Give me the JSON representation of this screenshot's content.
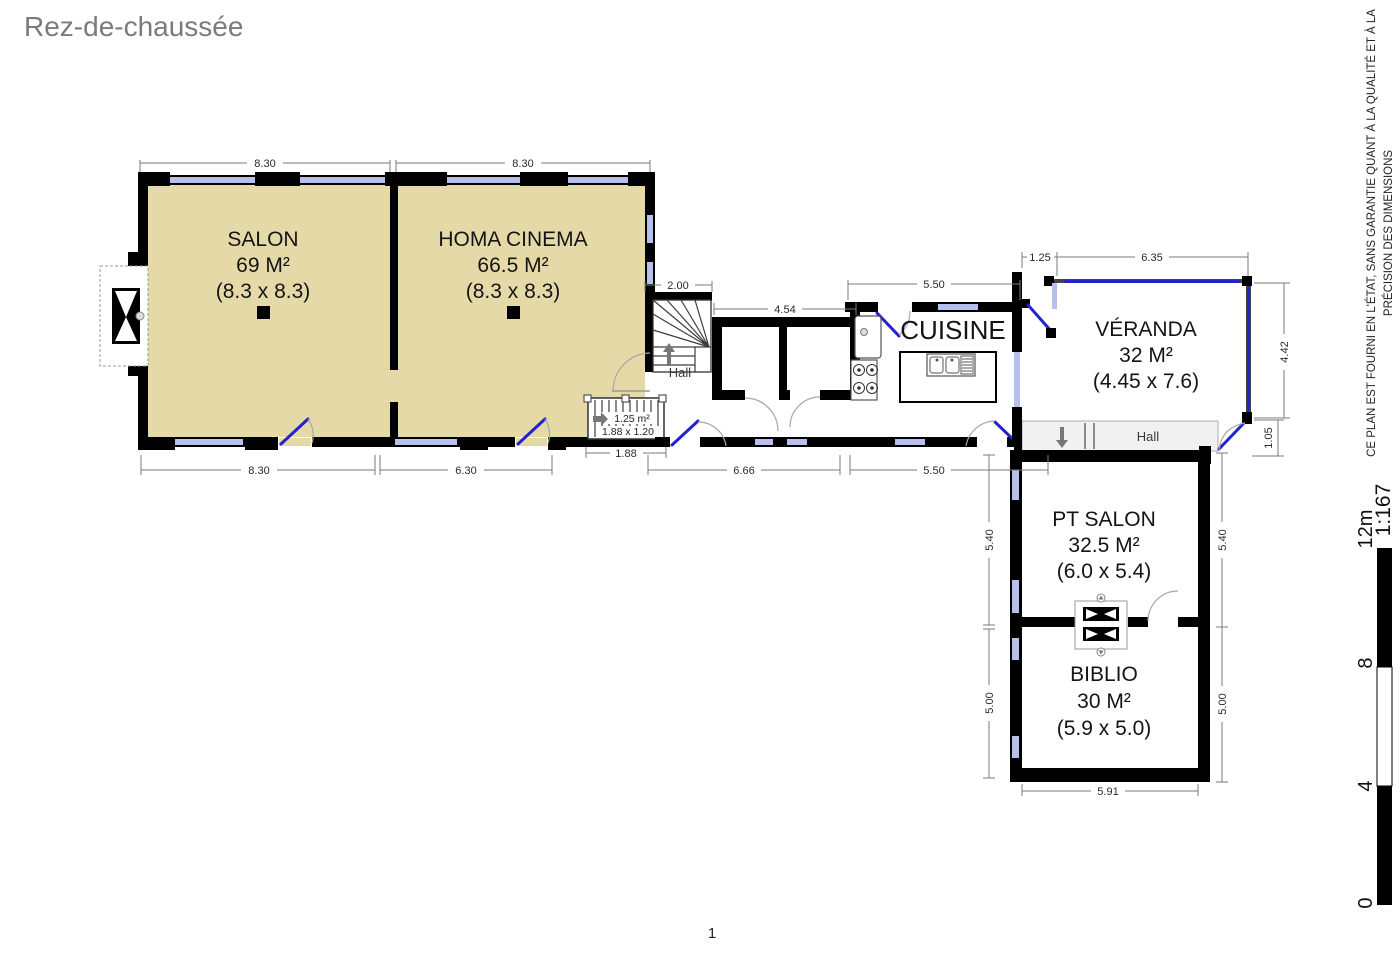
{
  "title": "Rez-de-chaussée",
  "page_number": "1",
  "disclaimer": {
    "line1": "CE PLAN EST FOURNI EN L'ÉTAT, SANS GARANTIE QUANT À LA QUALITÉ ET À LA",
    "line2": "PRÉCISION DES DIMENSIONS"
  },
  "scale_bar": {
    "top_label": "12m",
    "ratio": "1:167",
    "ticks": [
      "8",
      "4",
      "0"
    ]
  },
  "rooms": {
    "salon": {
      "name": "SALON",
      "area": "69 M²",
      "size": "(8.3 x 8.3)"
    },
    "homa_cinema": {
      "name": "HOMA CINEMA",
      "area": "66.5 M²",
      "size": "(8.3 x 8.3)"
    },
    "cuisine": {
      "name": "CUISINE"
    },
    "veranda": {
      "name": "VÉRANDA",
      "area": "32 M²",
      "size": "(4.45 x 7.6)"
    },
    "pt_salon": {
      "name": "PT SALON",
      "area": "32.5 M²",
      "size": "(6.0 x 5.4)"
    },
    "biblio": {
      "name": "BIBLIO",
      "area": "30 M²",
      "size": "(5.9 x 5.0)"
    },
    "hall_main": {
      "name": "Hall"
    },
    "hall_right": {
      "name": "Hall"
    },
    "closet": {
      "area": "1.25 m²",
      "size": "1.88 x 1.20"
    }
  },
  "dimensions": {
    "salon_top": "8.30",
    "cinema_top": "8.30",
    "salon_bottom": "8.30",
    "cinema_bottom": "6.30",
    "stair_width": "2.00",
    "closets_width": "4.54",
    "kitchen_top": "5.50",
    "closet_bottom": "1.88",
    "corridor_left": "6.66",
    "corridor_right": "5.50",
    "veranda_offset": "1.25",
    "veranda_top": "6.35",
    "veranda_right": "4.42",
    "hall_right_h": "1.05",
    "pt_salon_left": "5.40",
    "pt_salon_right": "5.40",
    "biblio_left": "5.00",
    "biblio_right": "5.00",
    "biblio_bottom": "5.91"
  },
  "colors": {
    "room_fill": "#e6d9a8",
    "wall": "#000000",
    "window": "#b7bfec",
    "door": "#2323cd",
    "dim_line": "#7a7a7a",
    "title_text": "#7b7b7b"
  }
}
